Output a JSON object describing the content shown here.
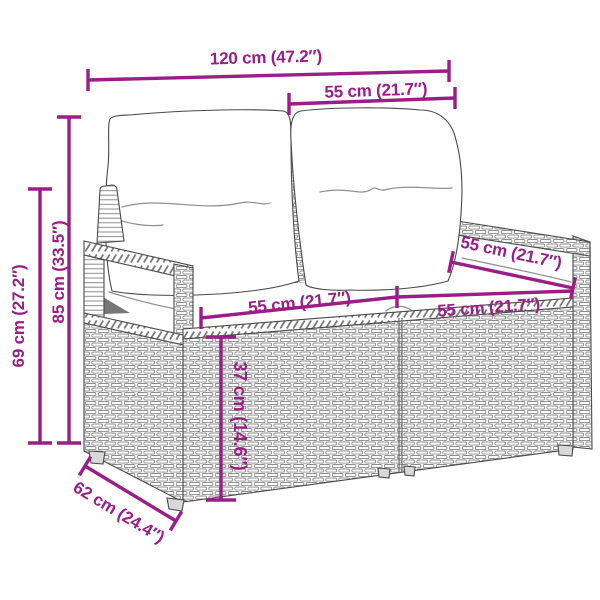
{
  "style": {
    "dimension_color": "#9b1d87",
    "line_art_outline": "#4a4a4a",
    "weave_gray": "#8d8d8d",
    "cushion_white": "#ffffff"
  },
  "dims": {
    "width_total": {
      "label": "120 cm (47.2″)",
      "cm": 120,
      "inches": 47.2
    },
    "back_section": {
      "label": "55 cm (21.7″)",
      "cm": 55,
      "inches": 21.7
    },
    "height_total": {
      "label": "85 cm (33.5″)",
      "cm": 85,
      "inches": 33.5
    },
    "arm_height": {
      "label": "69 cm (27.2″)",
      "cm": 69,
      "inches": 27.2
    },
    "seat_left": {
      "label": "55 cm (21.7″)",
      "cm": 55,
      "inches": 21.7
    },
    "seat_right": {
      "label": "55 cm (21.7″)",
      "cm": 55,
      "inches": 21.7
    },
    "seat_depth": {
      "label": "55 cm (21.7″)",
      "cm": 55,
      "inches": 21.7
    },
    "base_height": {
      "label": "37 cm (14.6″)",
      "cm": 37,
      "inches": 14.6
    },
    "depth_total": {
      "label": "62 cm (24.4″)",
      "cm": 62,
      "inches": 24.4
    }
  }
}
